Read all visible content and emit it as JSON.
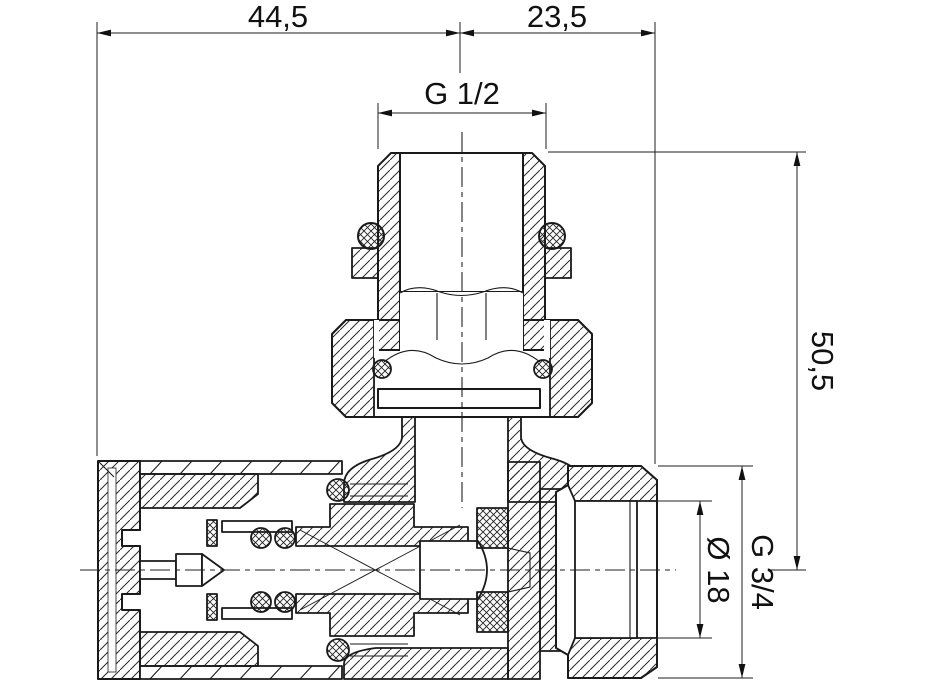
{
  "drawing": {
    "type": "technical-cross-section",
    "subject": "angle radiator valve, sectional view with dimensions",
    "background_color": "#ffffff",
    "line_color": "#1a1a1a",
    "dimensions": {
      "top_width_left": "44,5",
      "top_width_right": "23,5",
      "top_thread": "G 1/2",
      "height_right": "50,5",
      "outlet_bore": "Ø 18",
      "outlet_thread": "G 3/4"
    }
  }
}
